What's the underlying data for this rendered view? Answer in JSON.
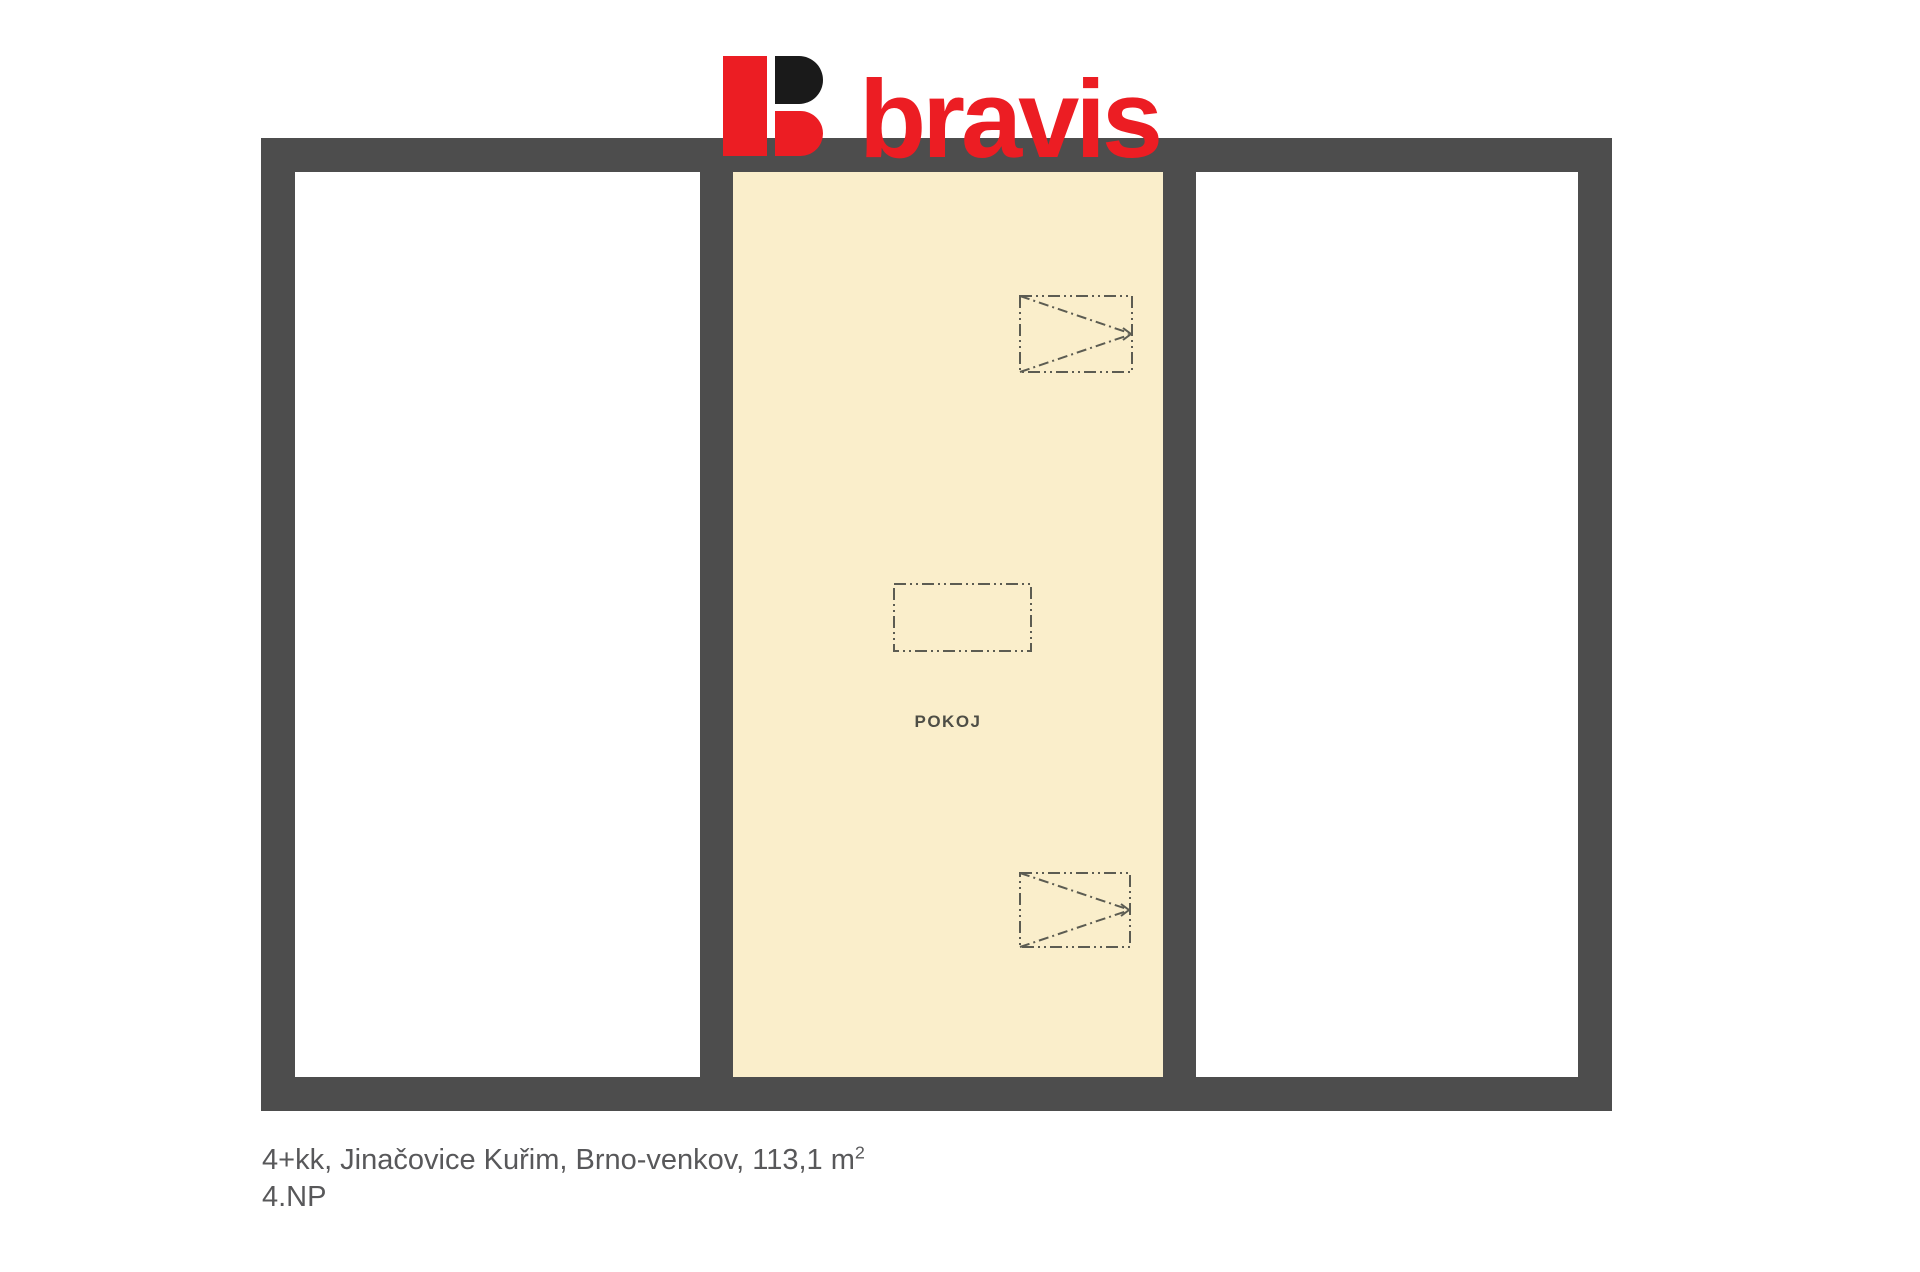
{
  "logo": {
    "text": "bravis",
    "mark": "b-glyph"
  },
  "colors": {
    "red": "#EC1D23",
    "black": "#1A1A1A",
    "wall": "#4D4D4D",
    "cream": "#FAEECB",
    "symbol": "#5C5C52",
    "caption": "#58585A",
    "label": "#4E4E46"
  },
  "floor_plan": {
    "center_room_label": "POKOJ",
    "rooms": [
      {
        "name": "left-room",
        "fill": "#FFFFFF",
        "label": ""
      },
      {
        "name": "center-room",
        "fill": "#FAEECB",
        "label": "POKOJ"
      },
      {
        "name": "right-room",
        "fill": "#FFFFFF",
        "label": ""
      }
    ],
    "symbols": [
      "window-swing-symbol-top",
      "furniture-rect-symbol",
      "window-swing-symbol-bottom"
    ]
  },
  "caption": {
    "line1": "4+kk, Jinačovice Kuřim, Brno-venkov, 113,1 m",
    "line1_sup": "2",
    "line2": "4.NP"
  }
}
